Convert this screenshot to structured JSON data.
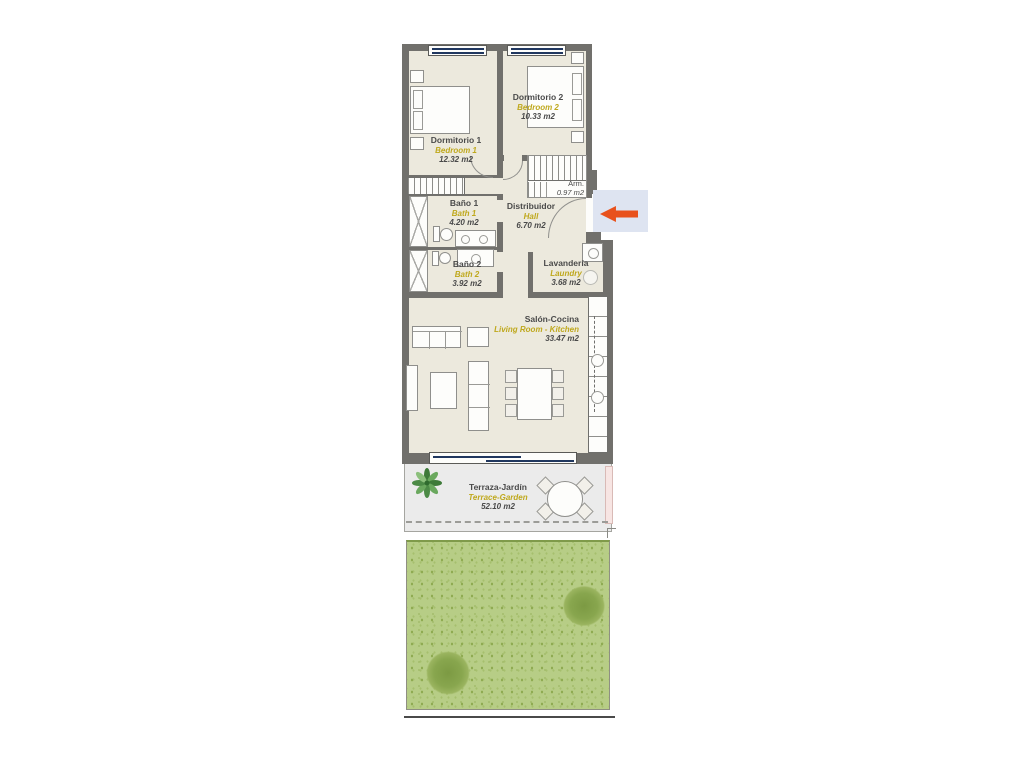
{
  "rooms": {
    "bedroom1": {
      "es": "Dormitorio 1",
      "en": "Bedroom 1",
      "area": "12.32 m2"
    },
    "bedroom2": {
      "es": "Dormitorio 2",
      "en": "Bedroom 2",
      "area": "10.33 m2"
    },
    "wardrobe": {
      "es": "Arm.",
      "area": "0.97 m2"
    },
    "bath1": {
      "es": "Baño 1",
      "en": "Bath 1",
      "area": "4.20 m2"
    },
    "hall": {
      "es": "Distribuidor",
      "en": "Hall",
      "area": "6.70 m2"
    },
    "bath2": {
      "es": "Baño 2",
      "en": "Bath 2",
      "area": "3.92 m2"
    },
    "laundry": {
      "es": "Lavandería",
      "en": "Laundry",
      "area": "3.68 m2"
    },
    "living": {
      "es": "Salón-Cocina",
      "en": "Living Room - Kitchen",
      "area": "33.47 m2"
    },
    "terrace": {
      "es": "Terraza-Jardín",
      "en": "Terrace-Garden",
      "area": "52.10 m2"
    }
  },
  "icons": {
    "entrance_arrow": "arrow-left",
    "plant": "plant",
    "washer": "washing-machine"
  },
  "colors": {
    "wall": "#71706c",
    "floor": "#ece9dd",
    "terrace_floor": "#ebebeb",
    "garden": "#b7cd86",
    "label_en_accent": "#bfa81c",
    "window_glass": "#20375f",
    "entrance_arrow": "#e8511c",
    "entrance_highlight": "#dee4f1"
  }
}
